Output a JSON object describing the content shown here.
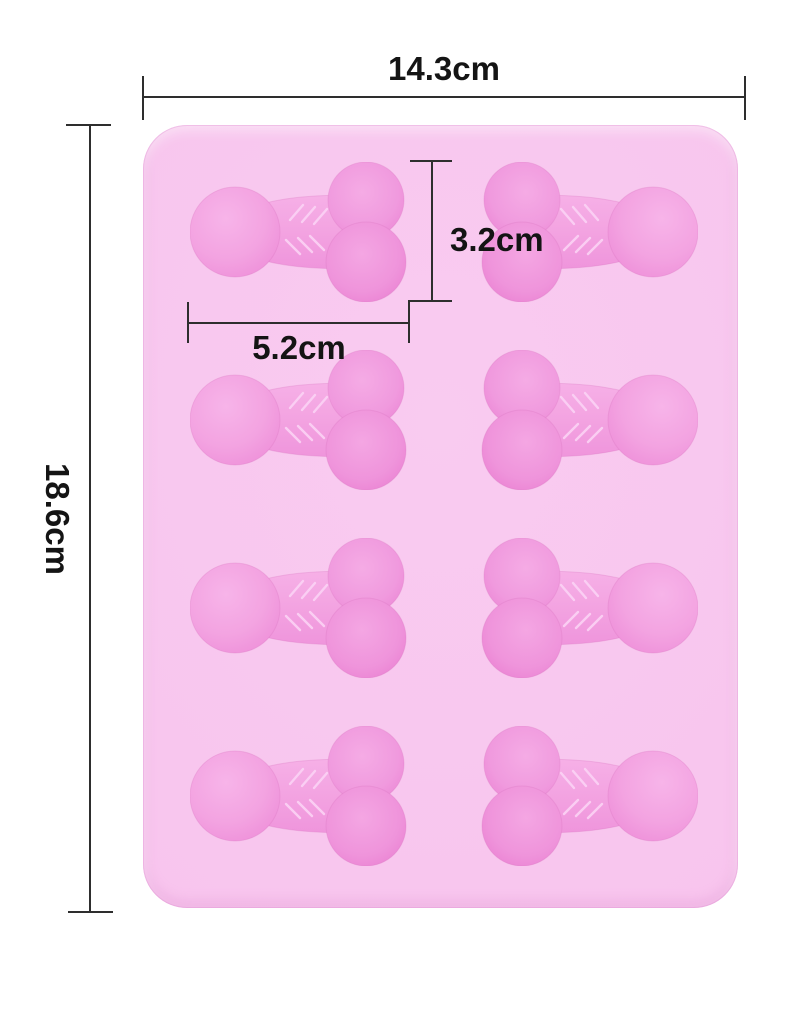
{
  "image": {
    "description": "Pink silicone novelty mold tray shown on white background with dimension annotations"
  },
  "dimensions": {
    "width_label": "14.3cm",
    "height_label": "18.6cm",
    "cavity_height_label": "3.2cm",
    "cavity_width_label": "5.2cm"
  },
  "product": {
    "type": "silicone-mold-tray",
    "cavity_rows": 4,
    "cavity_columns": 2,
    "cavity_count": 8,
    "cavity_shape": "novelty-bone-shape",
    "right_column_mirrored": true
  },
  "colors": {
    "background": "#ffffff",
    "tray": "#f8c5ee",
    "tray_deep": "#f3b4e7",
    "cavity": "#f3a4e2",
    "cavity_deep": "#ee8ed9",
    "chevron": "#fbd3f5",
    "dimension_line": "#2e2e2e",
    "label_text": "#141414"
  }
}
